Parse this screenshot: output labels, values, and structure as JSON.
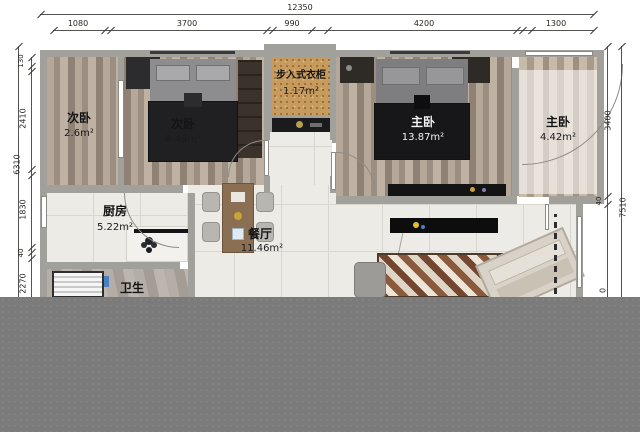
{
  "plan_title": "apartment-floor-plan",
  "rooms": [
    {
      "name": "次卧",
      "area": "2.6m²"
    },
    {
      "name": "次卧",
      "area": "8.49m²"
    },
    {
      "name": "步入式衣柜",
      "area": "1.17m²"
    },
    {
      "name": "主卧",
      "area": "13.87m²"
    },
    {
      "name": "主卧",
      "area": "4.42m²"
    },
    {
      "name": "厨房",
      "area": "5.22m²"
    },
    {
      "name": "餐厅",
      "area": "11.46m²"
    },
    {
      "name": "卫生",
      "area": ""
    }
  ],
  "dims": {
    "top": {
      "total": "12350",
      "segments": [
        "1080",
        "3700",
        "990",
        "4200",
        "1300"
      ]
    },
    "left": {
      "total": "6310",
      "segments": [
        "130",
        "2410",
        "1830",
        "40",
        "2270"
      ]
    },
    "right": {
      "inner_segments": [
        "3400",
        "40"
      ],
      "total": "7510",
      "cut_digit": "0"
    }
  },
  "colors": {
    "wall": "#a2a09b",
    "wood_floor": "#b0a295",
    "tile_floor": "#edebe6",
    "closet_cork": "#c79b5e",
    "bottom_band": "#7b7b7b",
    "accent_yellow_dot": "#e6c02a",
    "accent_blue_item": "#4a7fc0"
  }
}
